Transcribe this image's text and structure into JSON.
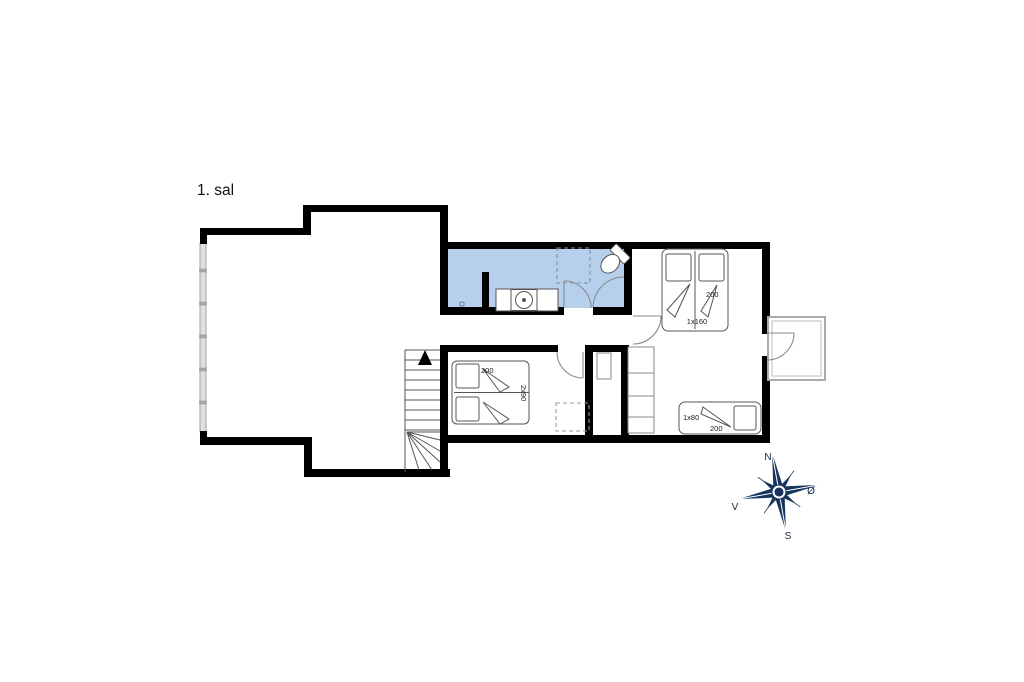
{
  "floor_plan": {
    "title": "1. sal",
    "colors": {
      "wall": "#000000",
      "bathroom_fill": "#b6cfeb",
      "compass_navy": "#17355e",
      "window_fill": "#e0e0e0"
    },
    "bed_labels": {
      "double_bed_width": "200",
      "double_bed_size": "1x160",
      "twin_bed_width": "200",
      "twin_bed_size": "2x90",
      "single_bed_size": "1x80",
      "single_bed_length": "200"
    },
    "compass": {
      "north": "N",
      "east": "Ø",
      "south": "S",
      "west": "V"
    }
  }
}
